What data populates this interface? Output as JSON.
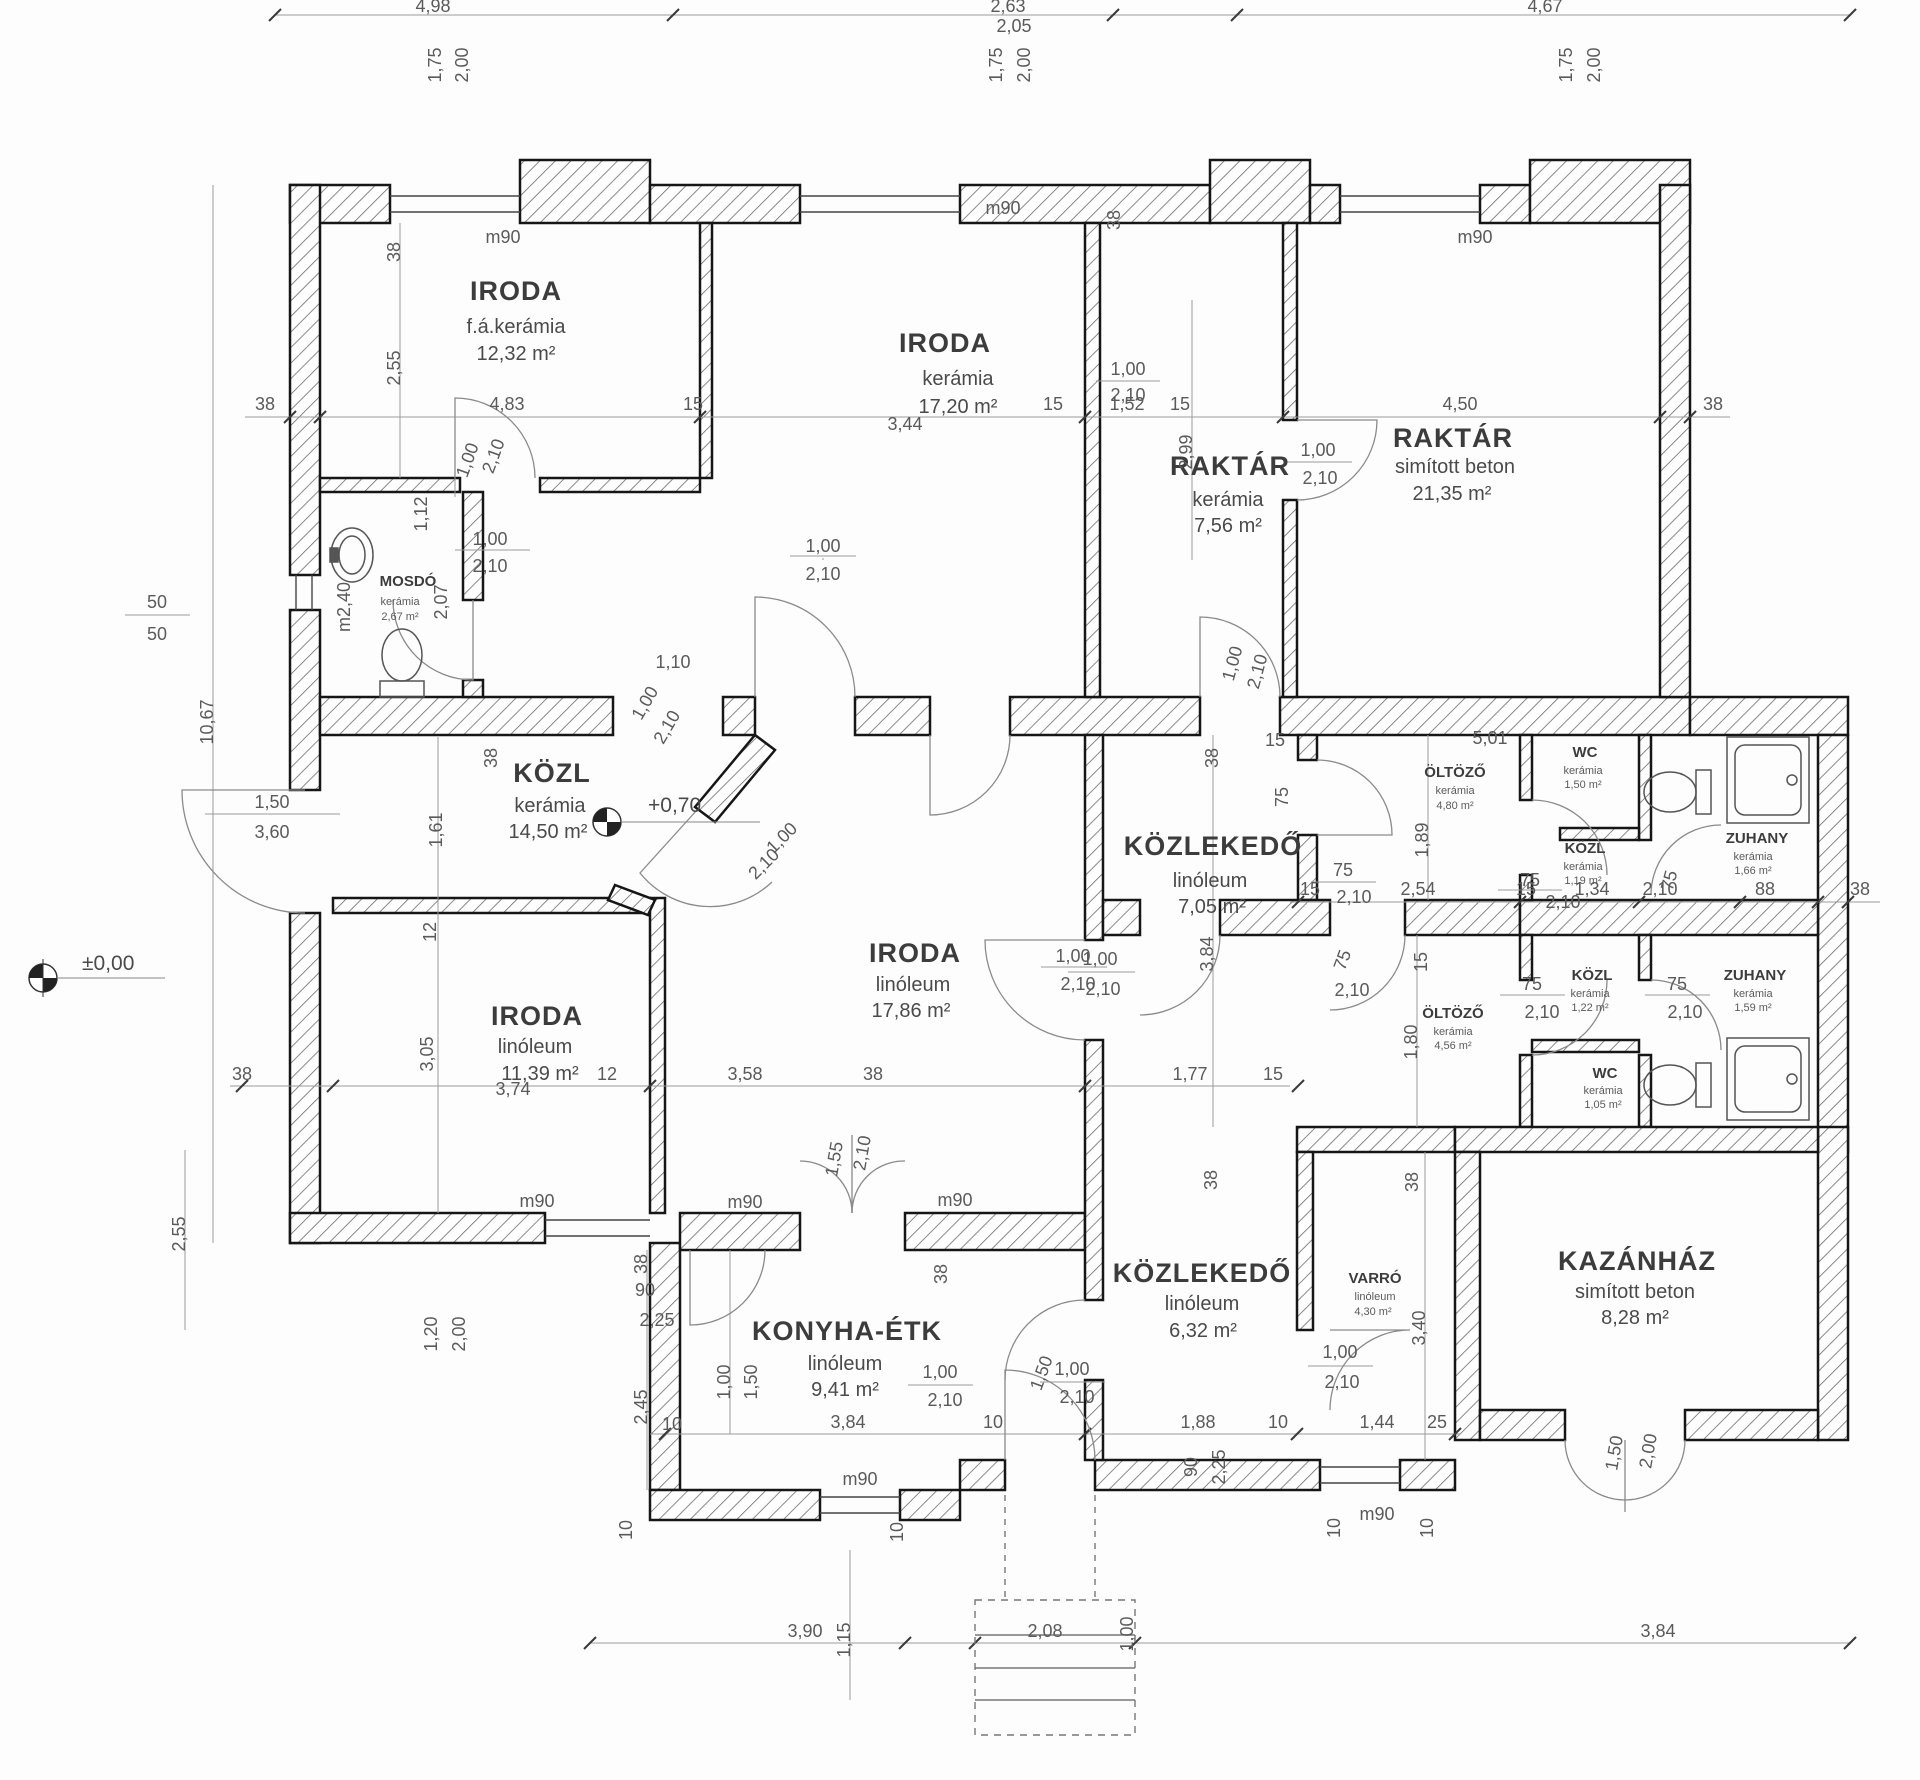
{
  "rooms": [
    {
      "name": "IRODA",
      "material": "f.á.kerámia",
      "area": "12,32 m²"
    },
    {
      "name": "IRODA",
      "material": "kerámia",
      "area": "17,20 m²"
    },
    {
      "name": "RAKTÁR",
      "material": "kerámia",
      "area": "7,56 m²"
    },
    {
      "name": "RAKTÁR",
      "material": "simított beton",
      "area": "21,35 m²"
    },
    {
      "name": "MOSDÓ",
      "material": "kerámia",
      "area": "2,67 m²"
    },
    {
      "name": "KÖZL",
      "material": "kerámia",
      "area": "14,50 m²"
    },
    {
      "name": "IRODA",
      "material": "linóleum",
      "area": "17,86 m²"
    },
    {
      "name": "IRODA",
      "material": "linóleum",
      "area": "11,39 m²"
    },
    {
      "name": "KÖZLEKEDŐ",
      "material": "linóleum",
      "area": "7,05 m²"
    },
    {
      "name": "ÖLTÖZŐ",
      "material": "kerámia",
      "area": "4,80 m²"
    },
    {
      "name": "WC",
      "material": "kerámia",
      "area": "1,50 m²"
    },
    {
      "name": "KÖZL",
      "material": "kerámia",
      "area": "1,19 m²"
    },
    {
      "name": "ZUHANY",
      "material": "kerámia",
      "area": "1,66 m²"
    },
    {
      "name": "ÖLTÖZŐ",
      "material": "kerámia",
      "area": "4,56 m²"
    },
    {
      "name": "KÖZL",
      "material": "kerámia",
      "area": "1,22 m²"
    },
    {
      "name": "ZUHANY",
      "material": "kerámia",
      "area": "1,59 m²"
    },
    {
      "name": "WC",
      "material": "kerámia",
      "area": "1,05 m²"
    },
    {
      "name": "KONYHA-ÉTK",
      "material": "linóleum",
      "area": "9,41 m²"
    },
    {
      "name": "KÖZLEKEDŐ",
      "material": "linóleum",
      "area": "6,32 m²"
    },
    {
      "name": "VARRÓ",
      "material": "linóleum",
      "area": "4,30 m²"
    },
    {
      "name": "KAZÁNHÁZ",
      "material": "simított beton",
      "area": "8,28 m²"
    }
  ],
  "levels": {
    "zero": "±0,00",
    "plus": "+0,70"
  },
  "dims": [
    "4,98",
    "1,75",
    "2,00",
    "2,63",
    "2,05",
    "1,75",
    "2,00",
    "4,67",
    "1,75",
    "2,00",
    "m90",
    "m90",
    "38",
    "m90",
    "38",
    "2,55",
    "38",
    "4,83",
    "15",
    "3,44",
    "15",
    "1,52",
    "15",
    "4,50",
    "38",
    "1,00",
    "2,10",
    "1,12",
    "1,00",
    "2,10",
    "2,07",
    "m2,40",
    "1,00",
    "2,10",
    "2,99",
    "1,00",
    "2,10",
    "50",
    "50",
    "10,67",
    "1,50",
    "3,60",
    "1,10",
    "38",
    "1,61",
    "12",
    "1,00",
    "2,10",
    "1,00",
    "2,10",
    "1,00",
    "2,10",
    "1,00",
    "2,10",
    "1,00",
    "2,10",
    "38",
    "15",
    "3,84",
    "75",
    "2,10",
    "5,01",
    "1,89",
    "75",
    "2,10",
    "75",
    "75",
    "15",
    "2,54",
    "15",
    "1,34",
    "2,10",
    "88",
    "38",
    "1,00",
    "2,10",
    "75",
    "2,10",
    "15",
    "1,80",
    "75",
    "2,10",
    "75",
    "2,10",
    "1,77",
    "15",
    "38",
    "3,58",
    "12",
    "3,74",
    "3,05",
    "38",
    "m90",
    "m90",
    "m90",
    "38",
    "38",
    "90",
    "2,25",
    "1,55",
    "2,10",
    "2,55",
    "1,20",
    "2,00",
    "2,45",
    "1,00",
    "1,50",
    "3,84",
    "10",
    "10",
    "1,00",
    "2,10",
    "1,50",
    "1,00",
    "2,10",
    "1,00",
    "2,10",
    "3,40",
    "38",
    "38",
    "1,88",
    "10",
    "1,44",
    "25",
    "90",
    "2,25",
    "10",
    "10",
    "m90",
    "m90",
    "10",
    "10",
    "3,90",
    "1,15",
    "2,08",
    "1,00",
    "3,84",
    "1,50",
    "2,00"
  ]
}
